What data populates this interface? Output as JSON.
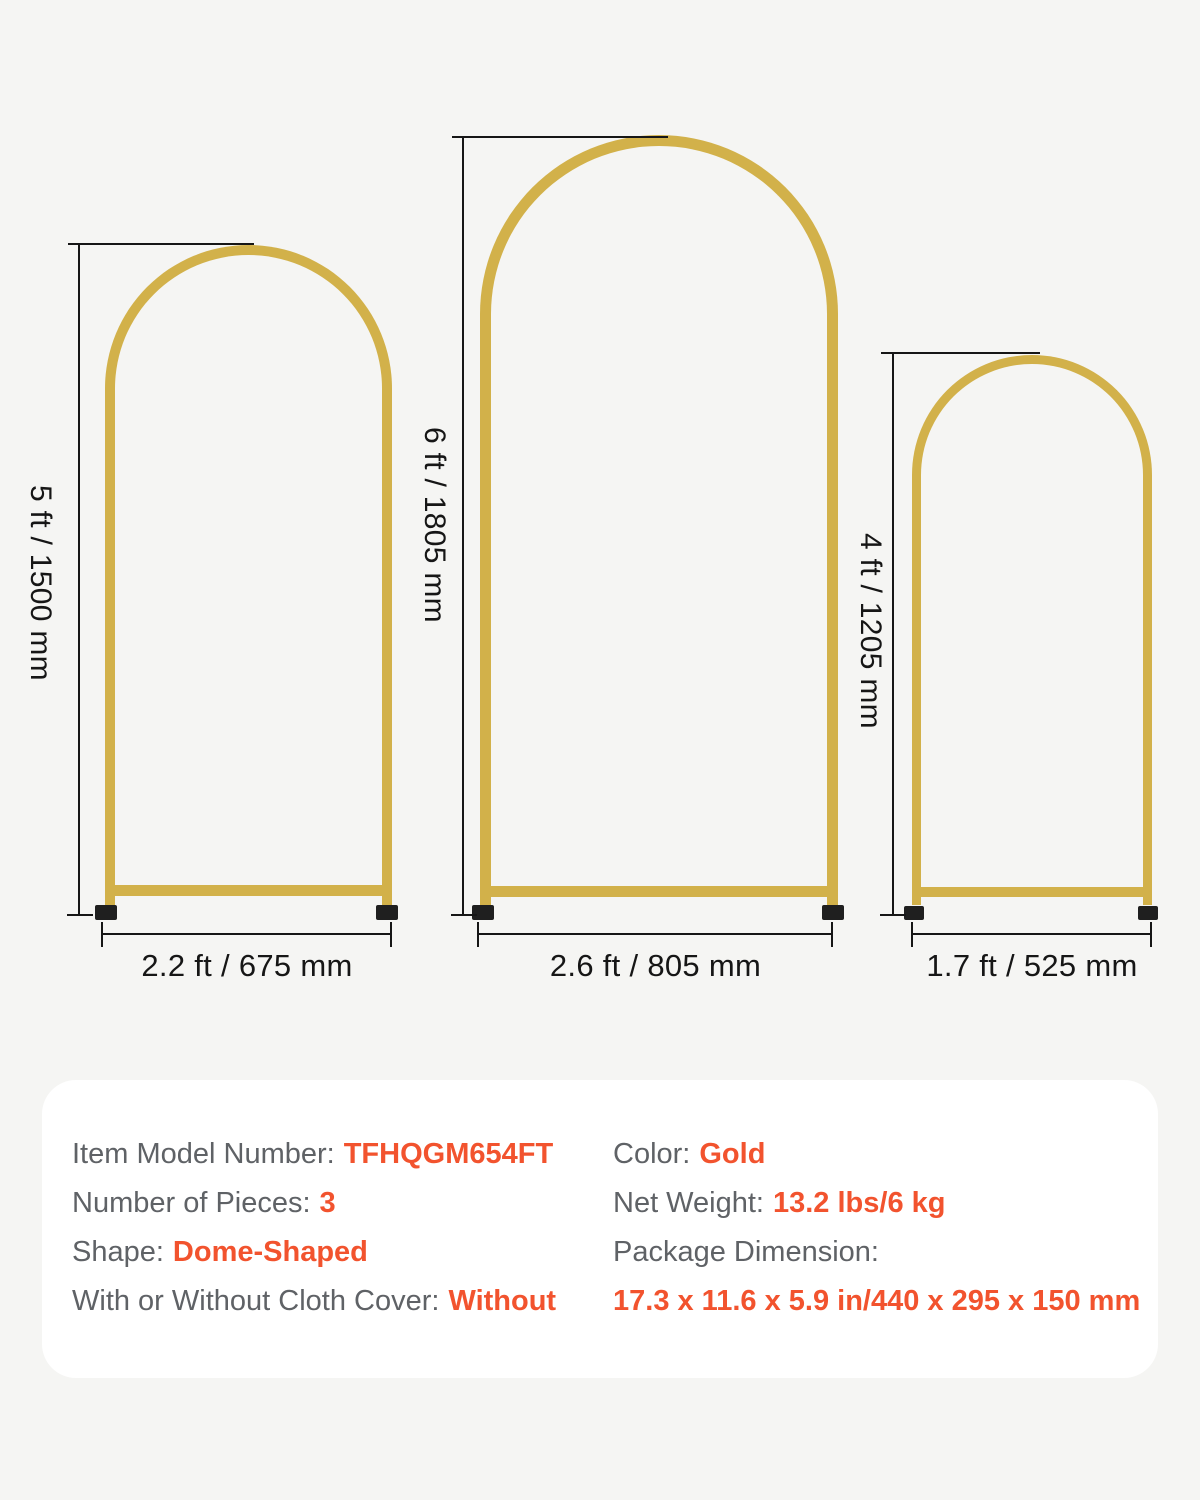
{
  "colors": {
    "bg": "#f5f5f3",
    "card": "#ffffff",
    "gold": "#d2b14a",
    "ink": "#161616",
    "gray": "#5f6266",
    "accent": "#f2532e",
    "foot": "#1f1f1f"
  },
  "arches": [
    {
      "name": "medium-arch",
      "height_label": "5 ft / 1500 mm",
      "width_label": "2.2 ft / 675 mm"
    },
    {
      "name": "large-arch",
      "height_label": "6 ft / 1805 mm",
      "width_label": "2.6 ft / 805 mm"
    },
    {
      "name": "small-arch",
      "height_label": "4 ft / 1205 mm",
      "width_label": "1.7 ft / 525 mm"
    }
  ],
  "specs": {
    "left_column": [
      {
        "label": "Item Model Number:",
        "value": "TFHQGM654FT"
      },
      {
        "label": "Number of Pieces:",
        "value": "3"
      },
      {
        "label": "Shape:",
        "value": "Dome-Shaped"
      },
      {
        "label": "With or Without Cloth Cover:",
        "value": "Without"
      }
    ],
    "right_column": [
      {
        "label": "Color:",
        "value": "Gold"
      },
      {
        "label": "Net Weight:",
        "value": "13.2 lbs/6 kg"
      },
      {
        "label": "Package Dimension:",
        "value": ""
      },
      {
        "label": "",
        "value": "17.3 x 11.6 x 5.9 in/440 x 295 x 150 mm"
      }
    ]
  }
}
